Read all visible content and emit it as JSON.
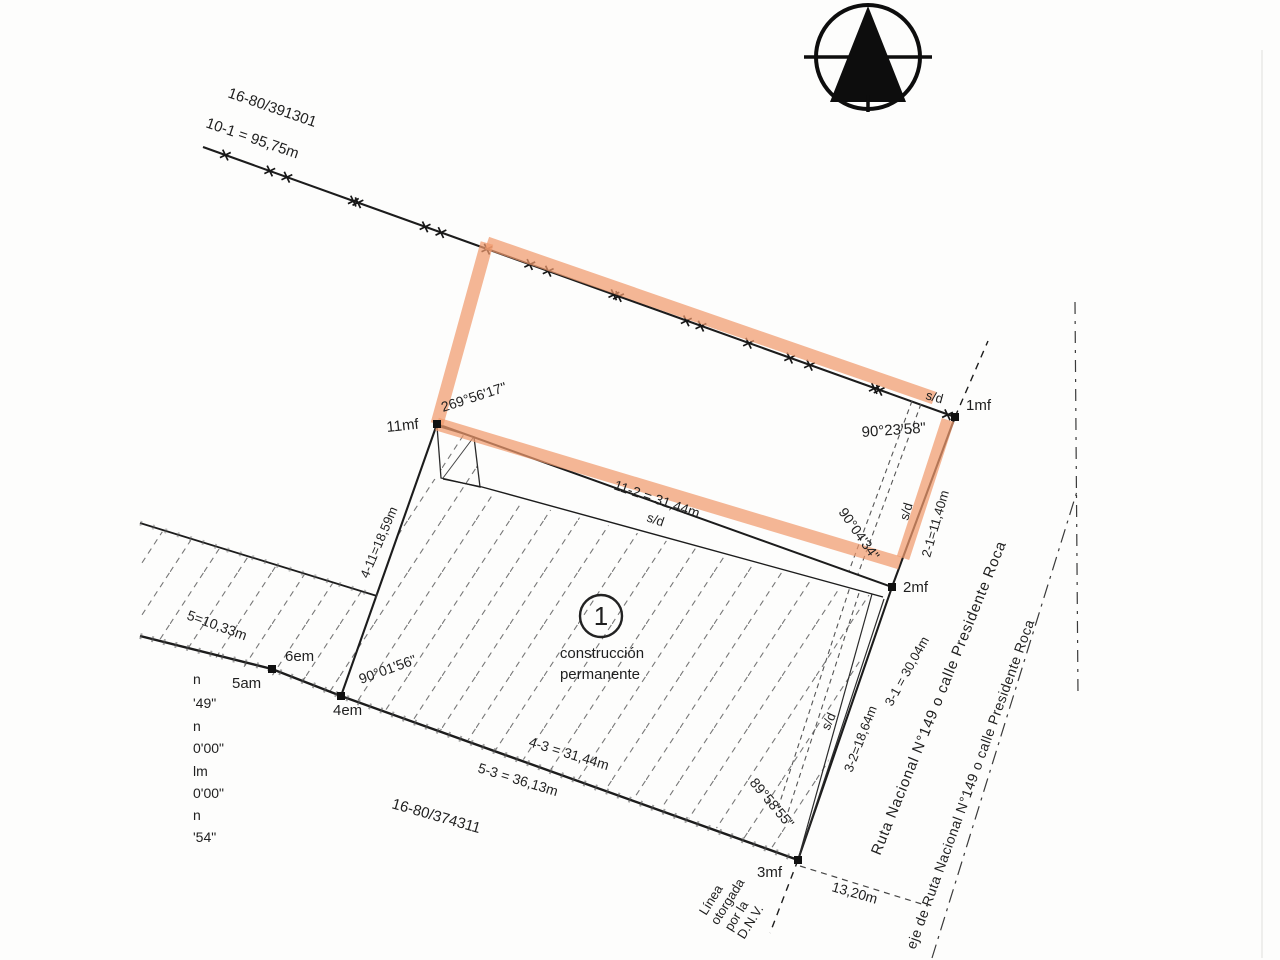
{
  "plan": {
    "parcels": {
      "north_plot": "16-80/391301",
      "south_plot": "16-80/374311"
    },
    "construction": {
      "number": "1",
      "line1": "construcción",
      "line2": "permanente"
    },
    "points": {
      "p1": "1mf",
      "p2": "2mf",
      "p3": "3mf",
      "p11": "11mf",
      "p4": "4em",
      "p5": "5am",
      "p6": "6em"
    },
    "distances": {
      "d10_1": "10-1 = 95,75m",
      "d11_2": "11-2 = 31,44m",
      "d2_1": "2-1=11,40m",
      "d4_11": "4-11=18,59m",
      "d6_5": "5=10,33m",
      "d4_3": "4-3 = 31,44m",
      "d5_3": "5-3 = 36,13m",
      "d3_2": "3-2=18,64m",
      "d3_1": "3-1 = 30,04m",
      "d13_20": "13,20m"
    },
    "angles": {
      "a11": "269°56'17\"",
      "a1": "90°23'58\"",
      "a2": "90°04'34\"",
      "a4": "90°01'56\"",
      "a3": "89°58'55\""
    },
    "sd": "s/d",
    "roads": {
      "ruta": "Ruta Nacional N°149 o calle Presidente Roca",
      "eje": "eje de Ruta Nacional N°149 o calle Presidente Roca"
    },
    "dnv": {
      "l1": "Línea",
      "l2": "otorgada",
      "l3": "por la",
      "l4": "D.N.V."
    },
    "edge_fragments": [
      "n",
      "'49\"",
      "n",
      "0'00\"",
      "lm",
      "0'00\"",
      "n",
      "'54\""
    ],
    "colors": {
      "highlight": "#f09a6e",
      "ink": "#1c1c1c"
    }
  }
}
